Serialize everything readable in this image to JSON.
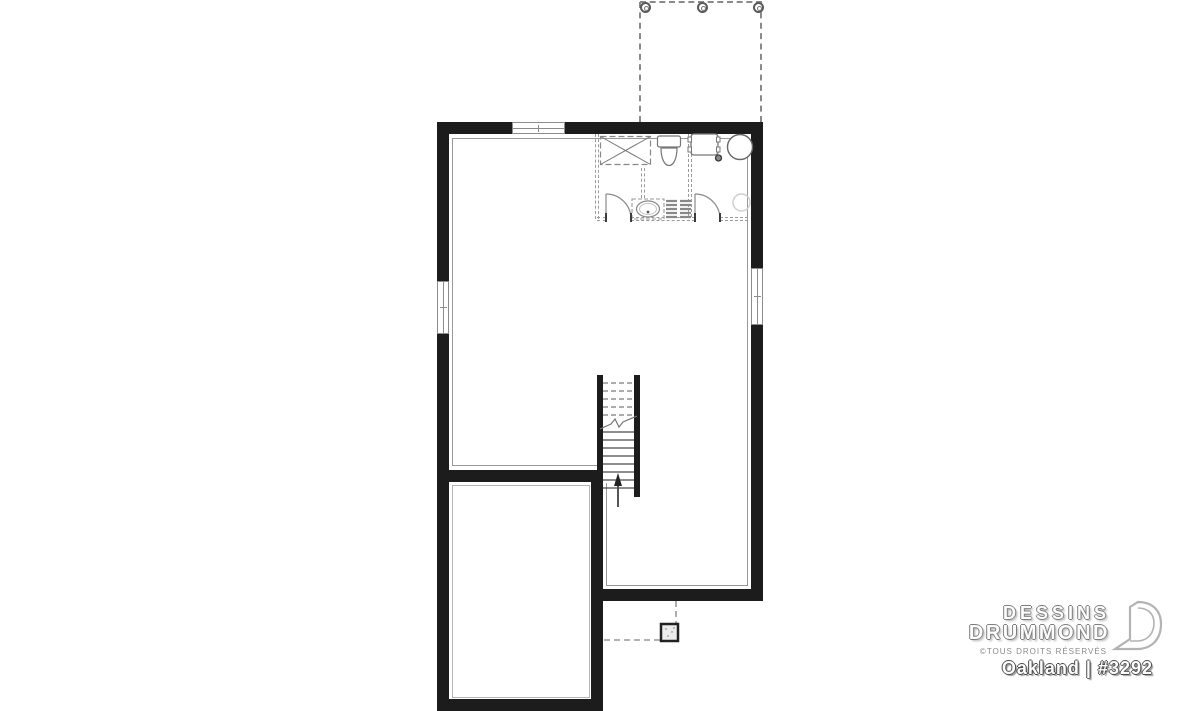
{
  "branding": {
    "line1": "DESSINS",
    "line2": "DRUMMOND",
    "rights": "©TOUS DROITS RÉSERVÉS",
    "plan_title": "Oakland | #3292",
    "logo": "drummond-d-mark"
  },
  "plan": {
    "type": "architectural-floor-plan",
    "level": "basement-foundation",
    "features": [
      "rear-deck-outline-dashed-with-3-posts",
      "bathroom-laundry-area-top-right: shower-with-x, toilet, vanity-sink, shelving, washer, floor-drain, water-heater, sump-circle",
      "two-swing-doors-in-dashed-partition",
      "central-staircase-with-up-arrow-and-break-line",
      "garage-room-bottom-left",
      "deck-post-footing-with-dashed-reference-lines",
      "windows: top-wall, left-wall, right-wall"
    ]
  },
  "colors": {
    "background": "#ffffff",
    "wall": "#1c1c1c",
    "finish_line": "#999999",
    "dashed_line": "#9b9b9b",
    "fixture_line": "#777777",
    "logo_gray": "#b3b3b3"
  }
}
